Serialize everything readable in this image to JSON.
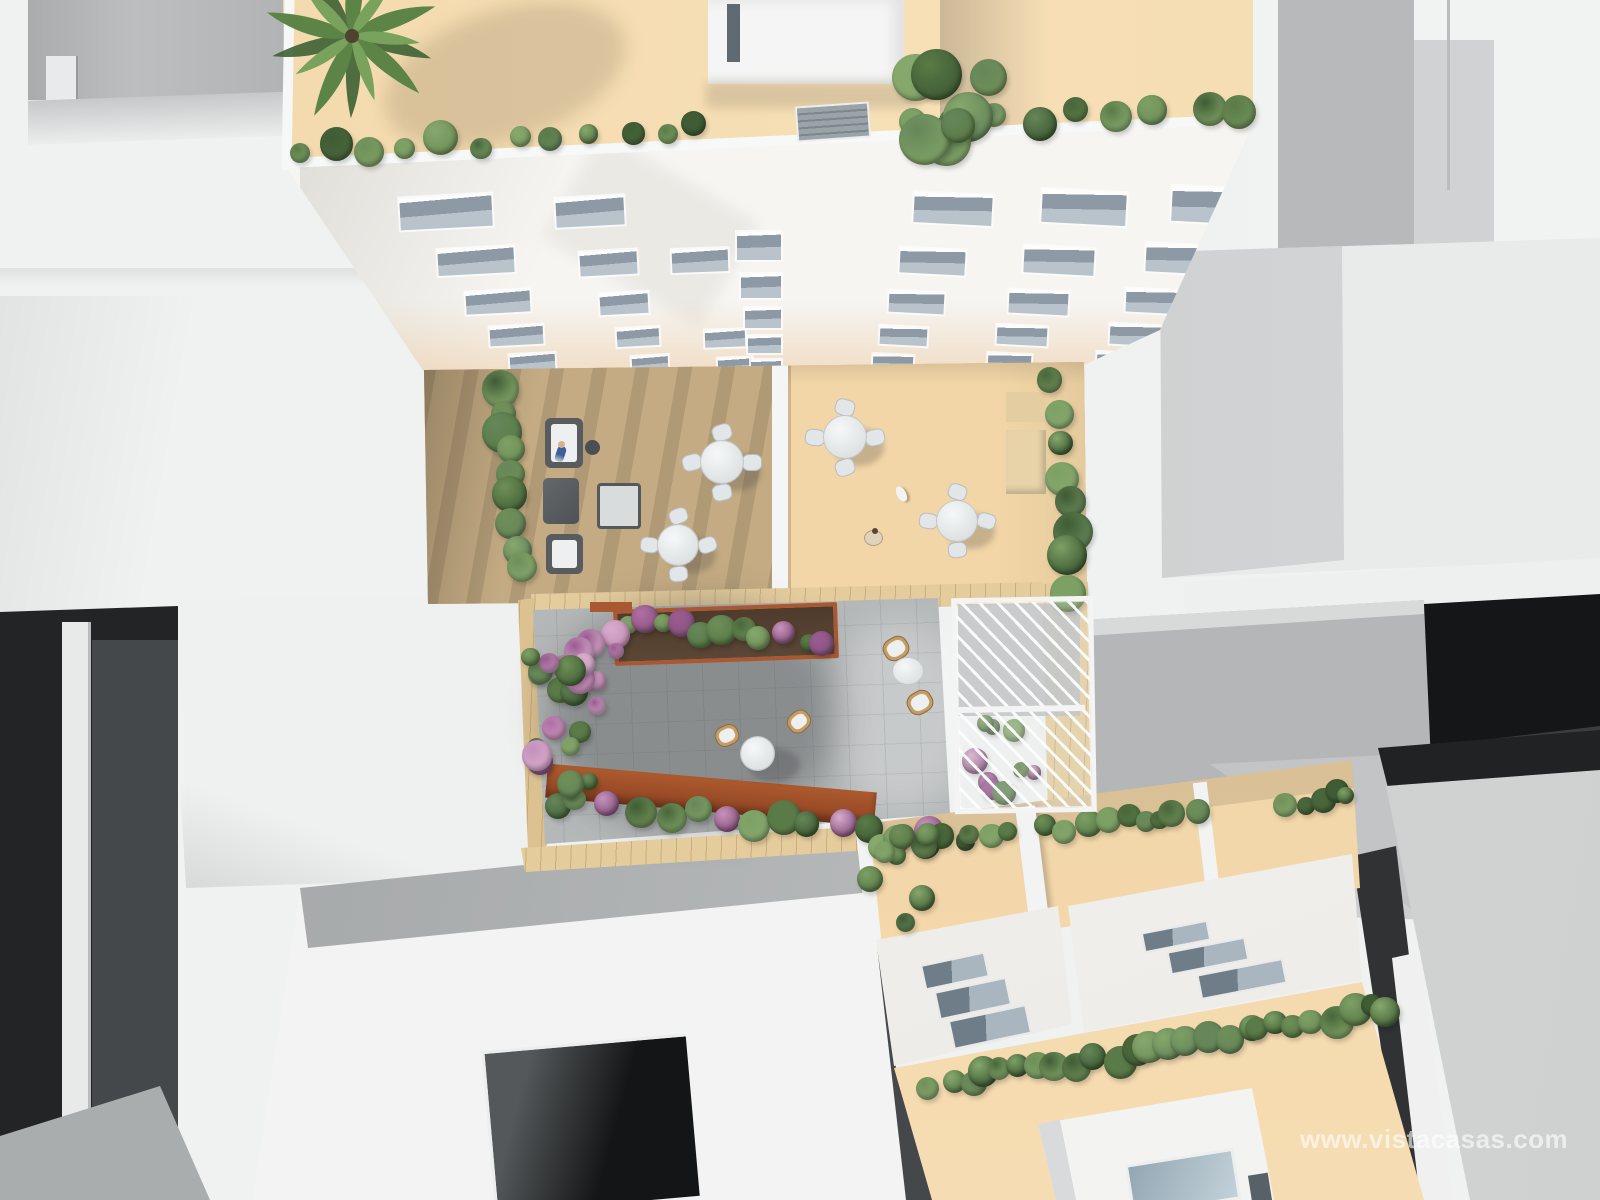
{
  "watermark": {
    "text": "www.vistacasas.com",
    "color": "#ffffff",
    "opacity": 0.78
  },
  "palette": {
    "white_massing": "#f1f2f2",
    "deep_shadow": "#141617",
    "roof_terrace_peach": "#f6ddb2",
    "right_terrace_peach": "#f2d6a7",
    "left_terrace_wood": "#c4ab83",
    "patio_concrete": "#b5b8b9",
    "tile_band_tan": "#e4cc9d",
    "corten_planter": "#aa5831",
    "window_glass": "#8d9aa5",
    "foliage_greens": [
      "#6f8f58",
      "#5a7b47",
      "#48663a",
      "#7da065",
      "#3f5c34",
      "#66875a",
      "#86a86d"
    ],
    "flower_pinks": [
      "#c792bb",
      "#b06fa4",
      "#d8abcc",
      "#9a5b90",
      "#c490bd"
    ]
  }
}
